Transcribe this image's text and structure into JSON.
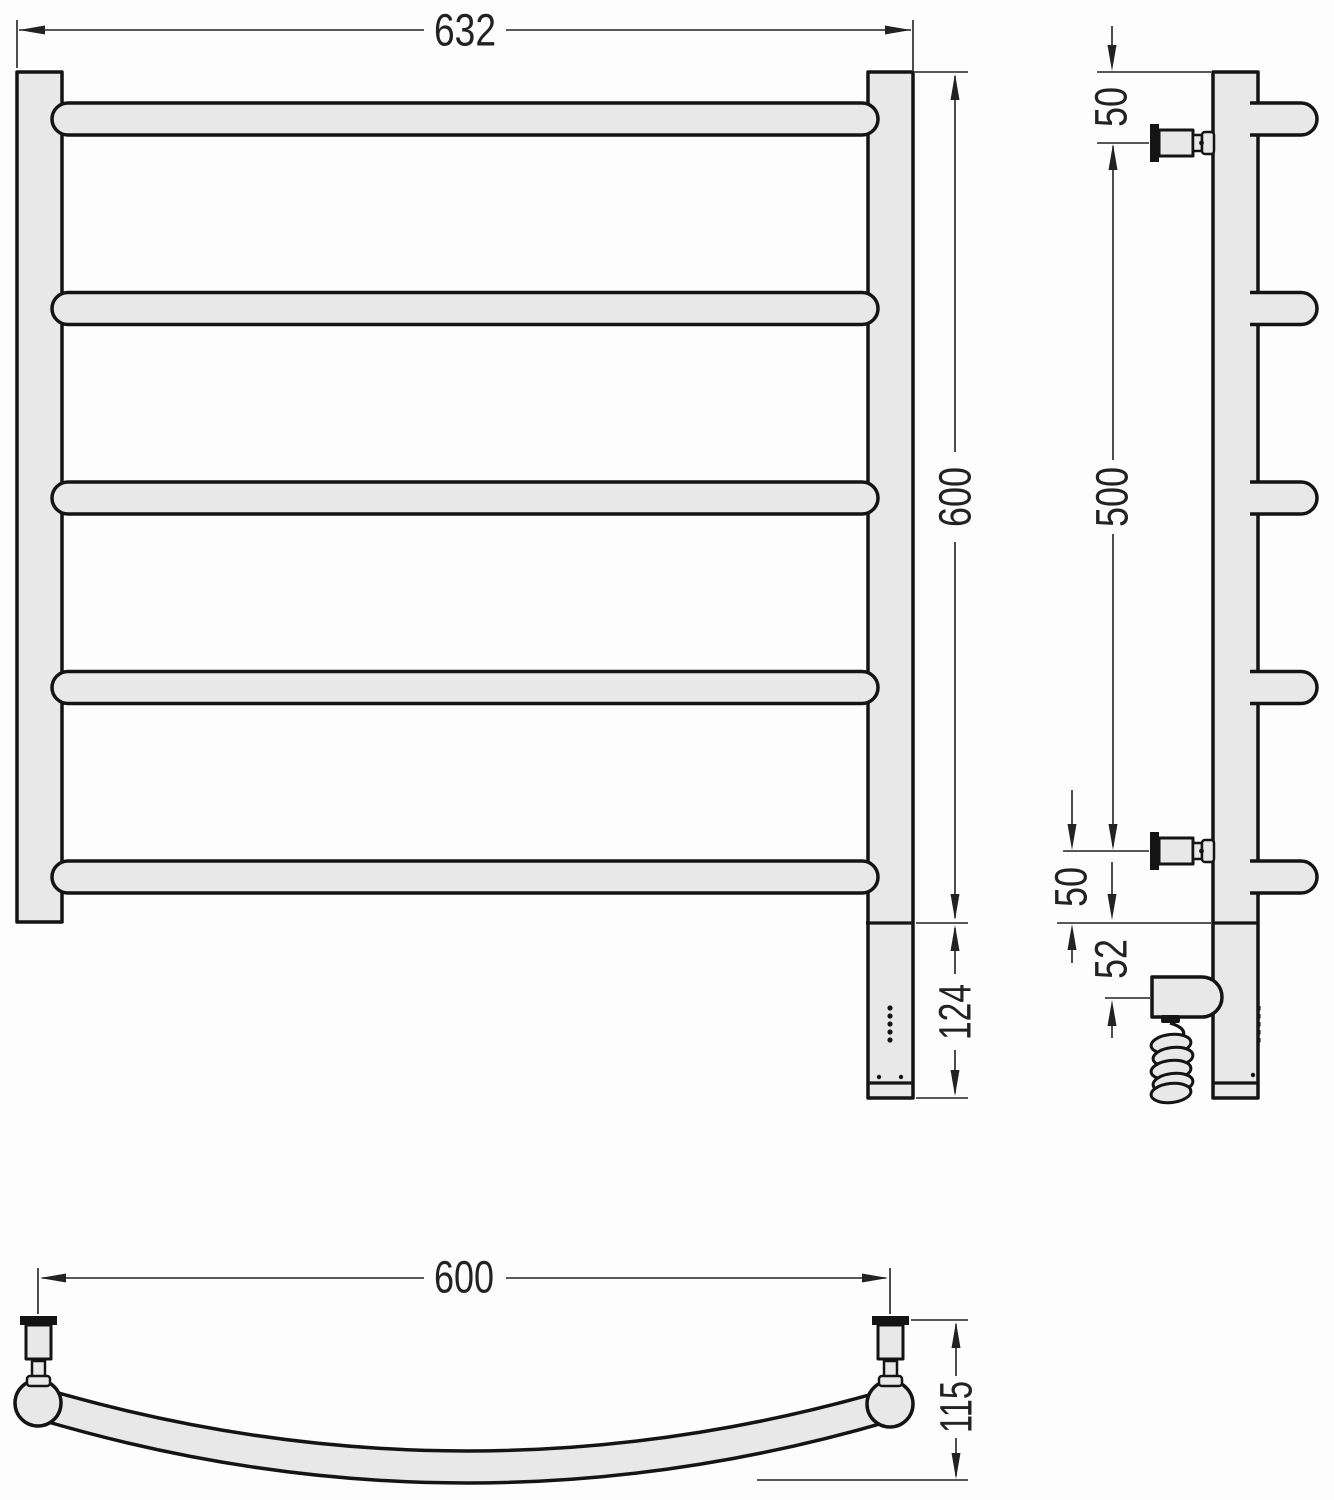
{
  "drawing": {
    "type": "technical-dimension-drawing",
    "subject": "curved ladder towel radiator shown in front, side and top orthographic views",
    "rail_count": 5,
    "colors": {
      "outline": "#141414",
      "fill": "#e8e8e8",
      "dimension_lines": "#222222",
      "background": "#fdfdfd"
    },
    "dims": {
      "front_width": "632",
      "front_height": "600",
      "front_bottom_section": "124",
      "side_top_to_bracket": "50",
      "side_bracket_span": "500",
      "side_bracket_to_bottom": "50",
      "side_bottom_to_heater": "52",
      "top_mount_spacing": "600",
      "top_depth": "115"
    }
  }
}
